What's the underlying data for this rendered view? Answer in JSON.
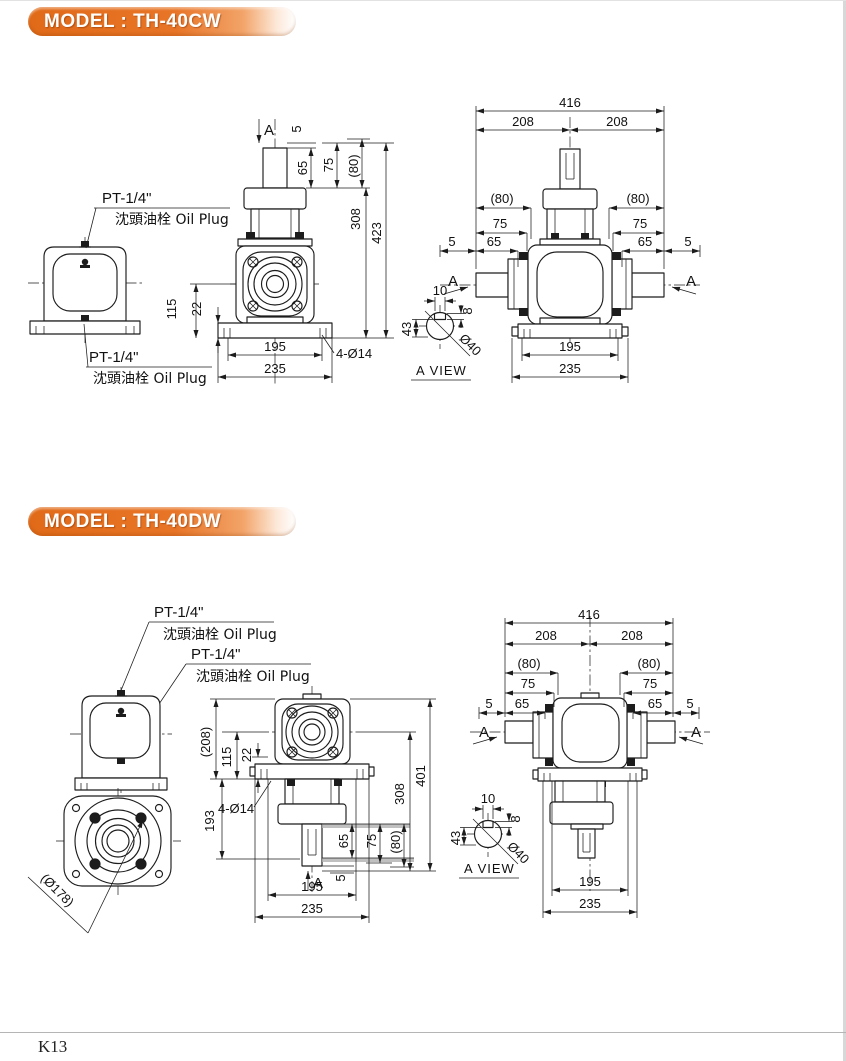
{
  "page": {
    "footer_page_number": "K13"
  },
  "sections": [
    {
      "header": "MODEL : TH-40CW",
      "callout_top": {
        "thread": "PT-1/4\"",
        "plug": "沈頭油栓 Oil Plug"
      },
      "callout_bottom": {
        "thread": "PT-1/4\"",
        "plug": "沈頭油栓 Oil Plug"
      },
      "front": {
        "section_label": "A",
        "d5": "5",
        "d65": "65",
        "d75": "75",
        "d80": "(80)",
        "d308": "308",
        "d423": "423",
        "d115": "115",
        "d22": "22",
        "d195": "195",
        "d235": "235",
        "holes": "4-Ø14"
      },
      "side": {
        "d416": "416",
        "d208_left": "208",
        "d208_right": "208",
        "left": {
          "d80": "(80)",
          "d75": "75",
          "d65": "65",
          "d5": "5",
          "a": "A"
        },
        "right": {
          "d80": "(80)",
          "d75": "75",
          "d65": "65",
          "d5": "5",
          "a": "A"
        },
        "d195": "195",
        "d235": "235"
      },
      "a_view": {
        "d10": "10",
        "d8": "8",
        "d43": "43",
        "d40": "Ø40",
        "label": "A VIEW"
      }
    },
    {
      "header": "MODEL : TH-40DW",
      "callout_top": {
        "thread": "PT-1/4\"",
        "plug": "沈頭油栓 Oil Plug"
      },
      "callout_bottom": {
        "thread": "PT-1/4\"",
        "plug": "沈頭油栓 Oil Plug"
      },
      "flange": {
        "dia": "(Ø178)"
      },
      "front": {
        "d208": "(208)",
        "d115": "115",
        "d22": "22",
        "d193": "193",
        "holes": "4-Ø14",
        "d65": "65",
        "d75": "75",
        "d80": "(80)",
        "d5": "5",
        "section_label": "A",
        "d308": "308",
        "d401": "401",
        "d195": "195",
        "d235": "235"
      },
      "side": {
        "d416": "416",
        "d208_left": "208",
        "d208_right": "208",
        "left": {
          "d80": "(80)",
          "d75": "75",
          "d65": "65",
          "d5": "5",
          "a": "A"
        },
        "right": {
          "d80": "(80)",
          "d75": "75",
          "d65": "65",
          "d5": "5",
          "a": "A"
        },
        "d195": "195",
        "d235": "235"
      },
      "a_view": {
        "d10": "10",
        "d8": "8",
        "d43": "43",
        "d40": "Ø40",
        "label": "A VIEW"
      }
    }
  ]
}
